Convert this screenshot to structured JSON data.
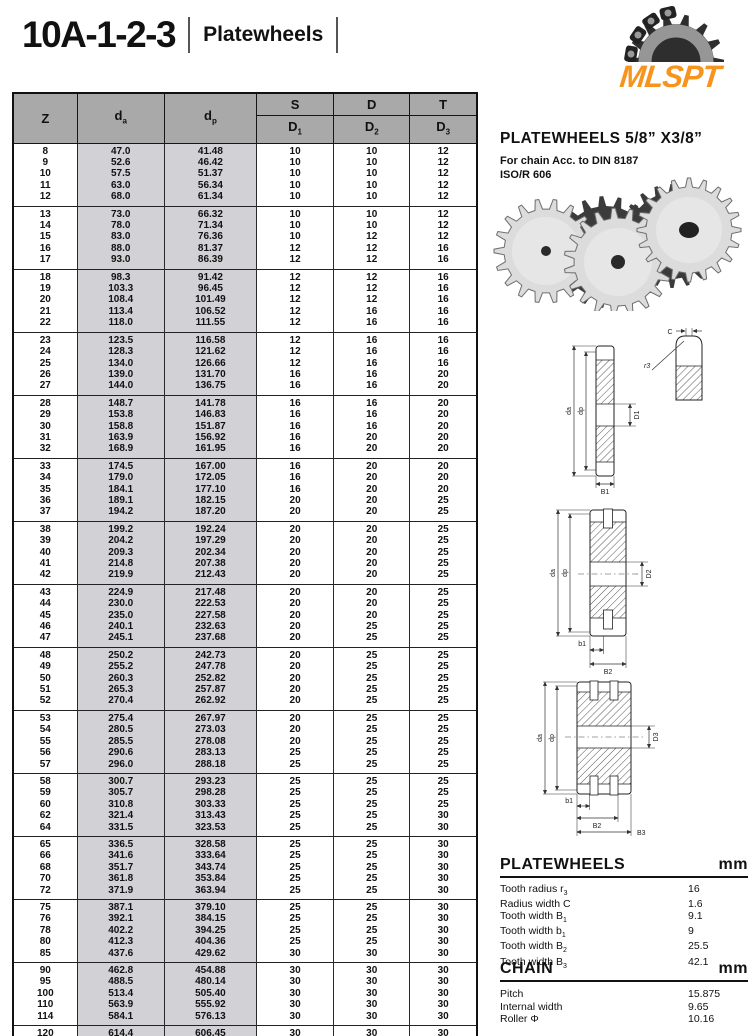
{
  "page": {
    "title": "10A-1-2-3",
    "subtitle": "Platewheels"
  },
  "logo": {
    "text": "MLSPT",
    "color": "#F7941D",
    "icon": "sprocket-chain-icon"
  },
  "table": {
    "header": {
      "z": "Z",
      "da": {
        "b": "d",
        "s": "a"
      },
      "dp": {
        "b": "d",
        "s": "p"
      },
      "s": "S",
      "d": "D",
      "t": "T",
      "d1": {
        "b": "D",
        "s": "1"
      },
      "d2": {
        "b": "D",
        "s": "2"
      },
      "d3": {
        "b": "D",
        "s": "3"
      }
    },
    "groups": [
      [
        [
          "8",
          "47.0",
          "41.48",
          "10",
          "10",
          "12"
        ],
        [
          "9",
          "52.6",
          "46.42",
          "10",
          "10",
          "12"
        ],
        [
          "10",
          "57.5",
          "51.37",
          "10",
          "10",
          "12"
        ],
        [
          "11",
          "63.0",
          "56.34",
          "10",
          "10",
          "12"
        ],
        [
          "12",
          "68.0",
          "61.34",
          "10",
          "10",
          "12"
        ]
      ],
      [
        [
          "13",
          "73.0",
          "66.32",
          "10",
          "10",
          "12"
        ],
        [
          "14",
          "78.0",
          "71.34",
          "10",
          "10",
          "12"
        ],
        [
          "15",
          "83.0",
          "76.36",
          "10",
          "12",
          "12"
        ],
        [
          "16",
          "88.0",
          "81.37",
          "12",
          "12",
          "16"
        ],
        [
          "17",
          "93.0",
          "86.39",
          "12",
          "12",
          "16"
        ]
      ],
      [
        [
          "18",
          "98.3",
          "91.42",
          "12",
          "12",
          "16"
        ],
        [
          "19",
          "103.3",
          "96.45",
          "12",
          "12",
          "16"
        ],
        [
          "20",
          "108.4",
          "101.49",
          "12",
          "12",
          "16"
        ],
        [
          "21",
          "113.4",
          "106.52",
          "12",
          "16",
          "16"
        ],
        [
          "22",
          "118.0",
          "111.55",
          "12",
          "16",
          "16"
        ]
      ],
      [
        [
          "23",
          "123.5",
          "116.58",
          "12",
          "16",
          "16"
        ],
        [
          "24",
          "128.3",
          "121.62",
          "12",
          "16",
          "16"
        ],
        [
          "25",
          "134.0",
          "126.66",
          "12",
          "16",
          "16"
        ],
        [
          "26",
          "139.0",
          "131.70",
          "16",
          "16",
          "20"
        ],
        [
          "27",
          "144.0",
          "136.75",
          "16",
          "16",
          "20"
        ]
      ],
      [
        [
          "28",
          "148.7",
          "141.78",
          "16",
          "16",
          "20"
        ],
        [
          "29",
          "153.8",
          "146.83",
          "16",
          "16",
          "20"
        ],
        [
          "30",
          "158.8",
          "151.87",
          "16",
          "16",
          "20"
        ],
        [
          "31",
          "163.9",
          "156.92",
          "16",
          "20",
          "20"
        ],
        [
          "32",
          "168.9",
          "161.95",
          "16",
          "20",
          "20"
        ]
      ],
      [
        [
          "33",
          "174.5",
          "167.00",
          "16",
          "20",
          "20"
        ],
        [
          "34",
          "179.0",
          "172.05",
          "16",
          "20",
          "20"
        ],
        [
          "35",
          "184.1",
          "177.10",
          "16",
          "20",
          "20"
        ],
        [
          "36",
          "189.1",
          "182.15",
          "20",
          "20",
          "25"
        ],
        [
          "37",
          "194.2",
          "187.20",
          "20",
          "20",
          "25"
        ]
      ],
      [
        [
          "38",
          "199.2",
          "192.24",
          "20",
          "20",
          "25"
        ],
        [
          "39",
          "204.2",
          "197.29",
          "20",
          "20",
          "25"
        ],
        [
          "40",
          "209.3",
          "202.34",
          "20",
          "20",
          "25"
        ],
        [
          "41",
          "214.8",
          "207.38",
          "20",
          "20",
          "25"
        ],
        [
          "42",
          "219.9",
          "212.43",
          "20",
          "20",
          "25"
        ]
      ],
      [
        [
          "43",
          "224.9",
          "217.48",
          "20",
          "20",
          "25"
        ],
        [
          "44",
          "230.0",
          "222.53",
          "20",
          "20",
          "25"
        ],
        [
          "45",
          "235.0",
          "227.58",
          "20",
          "20",
          "25"
        ],
        [
          "46",
          "240.1",
          "232.63",
          "20",
          "25",
          "25"
        ],
        [
          "47",
          "245.1",
          "237.68",
          "20",
          "25",
          "25"
        ]
      ],
      [
        [
          "48",
          "250.2",
          "242.73",
          "20",
          "25",
          "25"
        ],
        [
          "49",
          "255.2",
          "247.78",
          "20",
          "25",
          "25"
        ],
        [
          "50",
          "260.3",
          "252.82",
          "20",
          "25",
          "25"
        ],
        [
          "51",
          "265.3",
          "257.87",
          "20",
          "25",
          "25"
        ],
        [
          "52",
          "270.4",
          "262.92",
          "20",
          "25",
          "25"
        ]
      ],
      [
        [
          "53",
          "275.4",
          "267.97",
          "20",
          "25",
          "25"
        ],
        [
          "54",
          "280.5",
          "273.03",
          "20",
          "25",
          "25"
        ],
        [
          "55",
          "285.5",
          "278.08",
          "20",
          "25",
          "25"
        ],
        [
          "56",
          "290.6",
          "283.13",
          "25",
          "25",
          "25"
        ],
        [
          "57",
          "296.0",
          "288.18",
          "25",
          "25",
          "25"
        ]
      ],
      [
        [
          "58",
          "300.7",
          "293.23",
          "25",
          "25",
          "25"
        ],
        [
          "59",
          "305.7",
          "298.28",
          "25",
          "25",
          "25"
        ],
        [
          "60",
          "310.8",
          "303.33",
          "25",
          "25",
          "25"
        ],
        [
          "62",
          "321.4",
          "313.43",
          "25",
          "25",
          "30"
        ],
        [
          "64",
          "331.5",
          "323.53",
          "25",
          "25",
          "30"
        ]
      ],
      [
        [
          "65",
          "336.5",
          "328.58",
          "25",
          "25",
          "30"
        ],
        [
          "66",
          "341.6",
          "333.64",
          "25",
          "25",
          "30"
        ],
        [
          "68",
          "351.7",
          "343.74",
          "25",
          "25",
          "30"
        ],
        [
          "70",
          "361.8",
          "353.84",
          "25",
          "25",
          "30"
        ],
        [
          "72",
          "371.9",
          "363.94",
          "25",
          "25",
          "30"
        ]
      ],
      [
        [
          "75",
          "387.1",
          "379.10",
          "25",
          "25",
          "30"
        ],
        [
          "76",
          "392.1",
          "384.15",
          "25",
          "25",
          "30"
        ],
        [
          "78",
          "402.2",
          "394.25",
          "25",
          "25",
          "30"
        ],
        [
          "80",
          "412.3",
          "404.36",
          "25",
          "25",
          "30"
        ],
        [
          "85",
          "437.6",
          "429.62",
          "30",
          "30",
          "30"
        ]
      ],
      [
        [
          "90",
          "462.8",
          "454.88",
          "30",
          "30",
          "30"
        ],
        [
          "95",
          "488.5",
          "480.14",
          "30",
          "30",
          "30"
        ],
        [
          "100",
          "513.4",
          "505.40",
          "30",
          "30",
          "30"
        ],
        [
          "110",
          "563.9",
          "555.92",
          "30",
          "30",
          "30"
        ],
        [
          "114",
          "584.1",
          "576.13",
          "30",
          "30",
          "30"
        ]
      ],
      [
        [
          "120",
          "614.4",
          "606.45",
          "30",
          "30",
          "30"
        ],
        [
          "125",
          "639.7",
          "631.51",
          "30",
          "30",
          "30"
        ]
      ]
    ]
  },
  "product": {
    "heading": "PLATEWHEELS  5/8”  X3/8”",
    "line1": "For chain Acc. to DIN 8187",
    "line2": "ISO/R 606"
  },
  "diagrams": {
    "single": {
      "da": "da",
      "dp": "dp",
      "bore": "D1",
      "width": "B1",
      "c": "C",
      "r": "r3"
    },
    "double": {
      "da": "da",
      "dp": "dp",
      "bore": "D2",
      "b1": "b1",
      "b2": "B2"
    },
    "triple": {
      "da": "da",
      "dp": "dp",
      "bore": "D3",
      "b1": "b1",
      "b2": "B2",
      "b3": "B3"
    }
  },
  "specs": {
    "platewheels": {
      "title": "PLATEWHEELS",
      "unit": "mm",
      "rows": [
        {
          "label": "Tooth radius r",
          "sub": "3",
          "value": "16"
        },
        {
          "label": "Radius width C",
          "sub": "",
          "value": "1.6"
        },
        {
          "label": "Tooth width B",
          "sub": "1",
          "value": "9.1"
        },
        {
          "label": "Tooth width b",
          "sub": "1",
          "value": "9"
        },
        {
          "label": "Tooth width B",
          "sub": "2",
          "value": "25.5"
        },
        {
          "label": "Tooth width B",
          "sub": "3",
          "value": "42.1"
        }
      ]
    },
    "chain": {
      "title": "CHAIN",
      "unit": "mm",
      "rows": [
        {
          "label": "Pitch",
          "sub": "",
          "value": "15.875"
        },
        {
          "label": "Internal width",
          "sub": "",
          "value": "9.65"
        },
        {
          "label": "Roller Φ",
          "sub": "",
          "value": "10.16"
        }
      ]
    }
  }
}
